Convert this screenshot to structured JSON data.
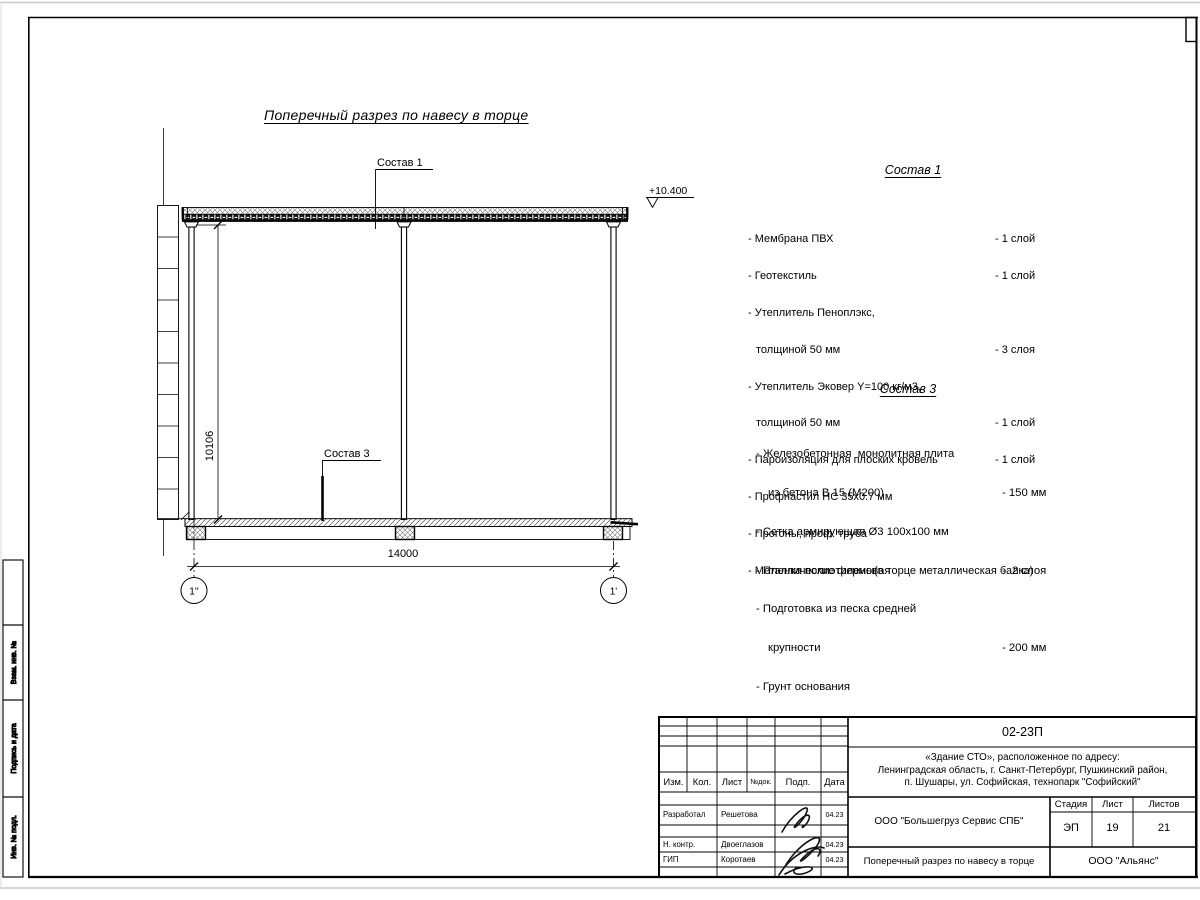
{
  "sheet": {
    "margin_label_top": "Взам. инв. №",
    "margin_label_mid": "Подпись и дата",
    "margin_label_bot": "Инв. № подл."
  },
  "drawing": {
    "title": "Поперечный разрез по навесу в торце",
    "elevation_mark": "+10.400",
    "leader1_label": "Состав 1",
    "leader3_label": "Состав 3",
    "dim_height": "10106",
    "dim_width": "14000",
    "axis_left": "1''",
    "axis_right": "1'"
  },
  "sostav1": {
    "title": "Состав 1",
    "items": [
      {
        "name": "- Мембрана ПВХ",
        "value": "- 1 слой"
      },
      {
        "name": "- Геотекстиль",
        "value": "- 1 слой"
      },
      {
        "name": "- Утеплитель Пеноплэкс,",
        "value": ""
      },
      {
        "name": "толщиной 50 мм",
        "value": "- 3 слоя"
      },
      {
        "name": "- Утеплитель Эковер Y=100 кг/м3,",
        "value": ""
      },
      {
        "name": "толщиной 50 мм",
        "value": "- 1 слой"
      },
      {
        "name": "- Пароизоляция для плоских кровель",
        "value": "- 1 слой"
      },
      {
        "name": "- Профнастил НС 35х0.7 мм",
        "value": ""
      },
      {
        "name": "- Прогоны, проф. труба",
        "value": ""
      },
      {
        "name": "- Металлические фермы(в торце металлическая балка)",
        "value": ""
      }
    ]
  },
  "sostav3": {
    "title": "Состав 3",
    "items": [
      {
        "name": "- Железобетонная  монолитная плита",
        "value": ""
      },
      {
        "name": "из бетона В 15 (М200)",
        "value": "- 150 мм"
      },
      {
        "name": "- Сетка армирующая Ø3 100х100 мм",
        "value": ""
      },
      {
        "name": "- Пленка полиэтиленовая",
        "value": "-  2 слоя"
      },
      {
        "name": "- Подготовка из песка средней",
        "value": ""
      },
      {
        "name": "крупности",
        "value": "- 200 мм"
      },
      {
        "name": "- Грунт основания",
        "value": ""
      }
    ]
  },
  "stamp": {
    "doc_number": "02-23П",
    "project_line1": "«Здание СТО», расположенное по адресу:",
    "project_line2": "Ленинградская область, г. Санкт-Петербург, Пушкинский район,",
    "project_line3": "п. Шушары, ул. Софийская, технопарк \"Софийский\"",
    "org": "ООО \"Большегруз Сервис СПБ\"",
    "stage_label": "Стадия",
    "sheet_label": "Лист",
    "sheets_label": "Листов",
    "stage": "ЭП",
    "sheet_no": "19",
    "sheets_total": "21",
    "sheet_title": "Поперечный разрез по навесу в торце",
    "company": "ООО \"Альянс\"",
    "header": {
      "izm": "Изм.",
      "kol": "Кол.",
      "list": "Лист",
      "ndok": "№док.",
      "podp": "Подп.",
      "data": "Дата"
    },
    "rows": [
      {
        "role": "Разработал",
        "name": "Решетова",
        "date": "04.23"
      },
      {
        "role": "Н. контр.",
        "name": "Двоеглазов",
        "date": "04.23"
      },
      {
        "role": "ГИП",
        "name": "Коротаев",
        "date": "04.23"
      }
    ]
  }
}
